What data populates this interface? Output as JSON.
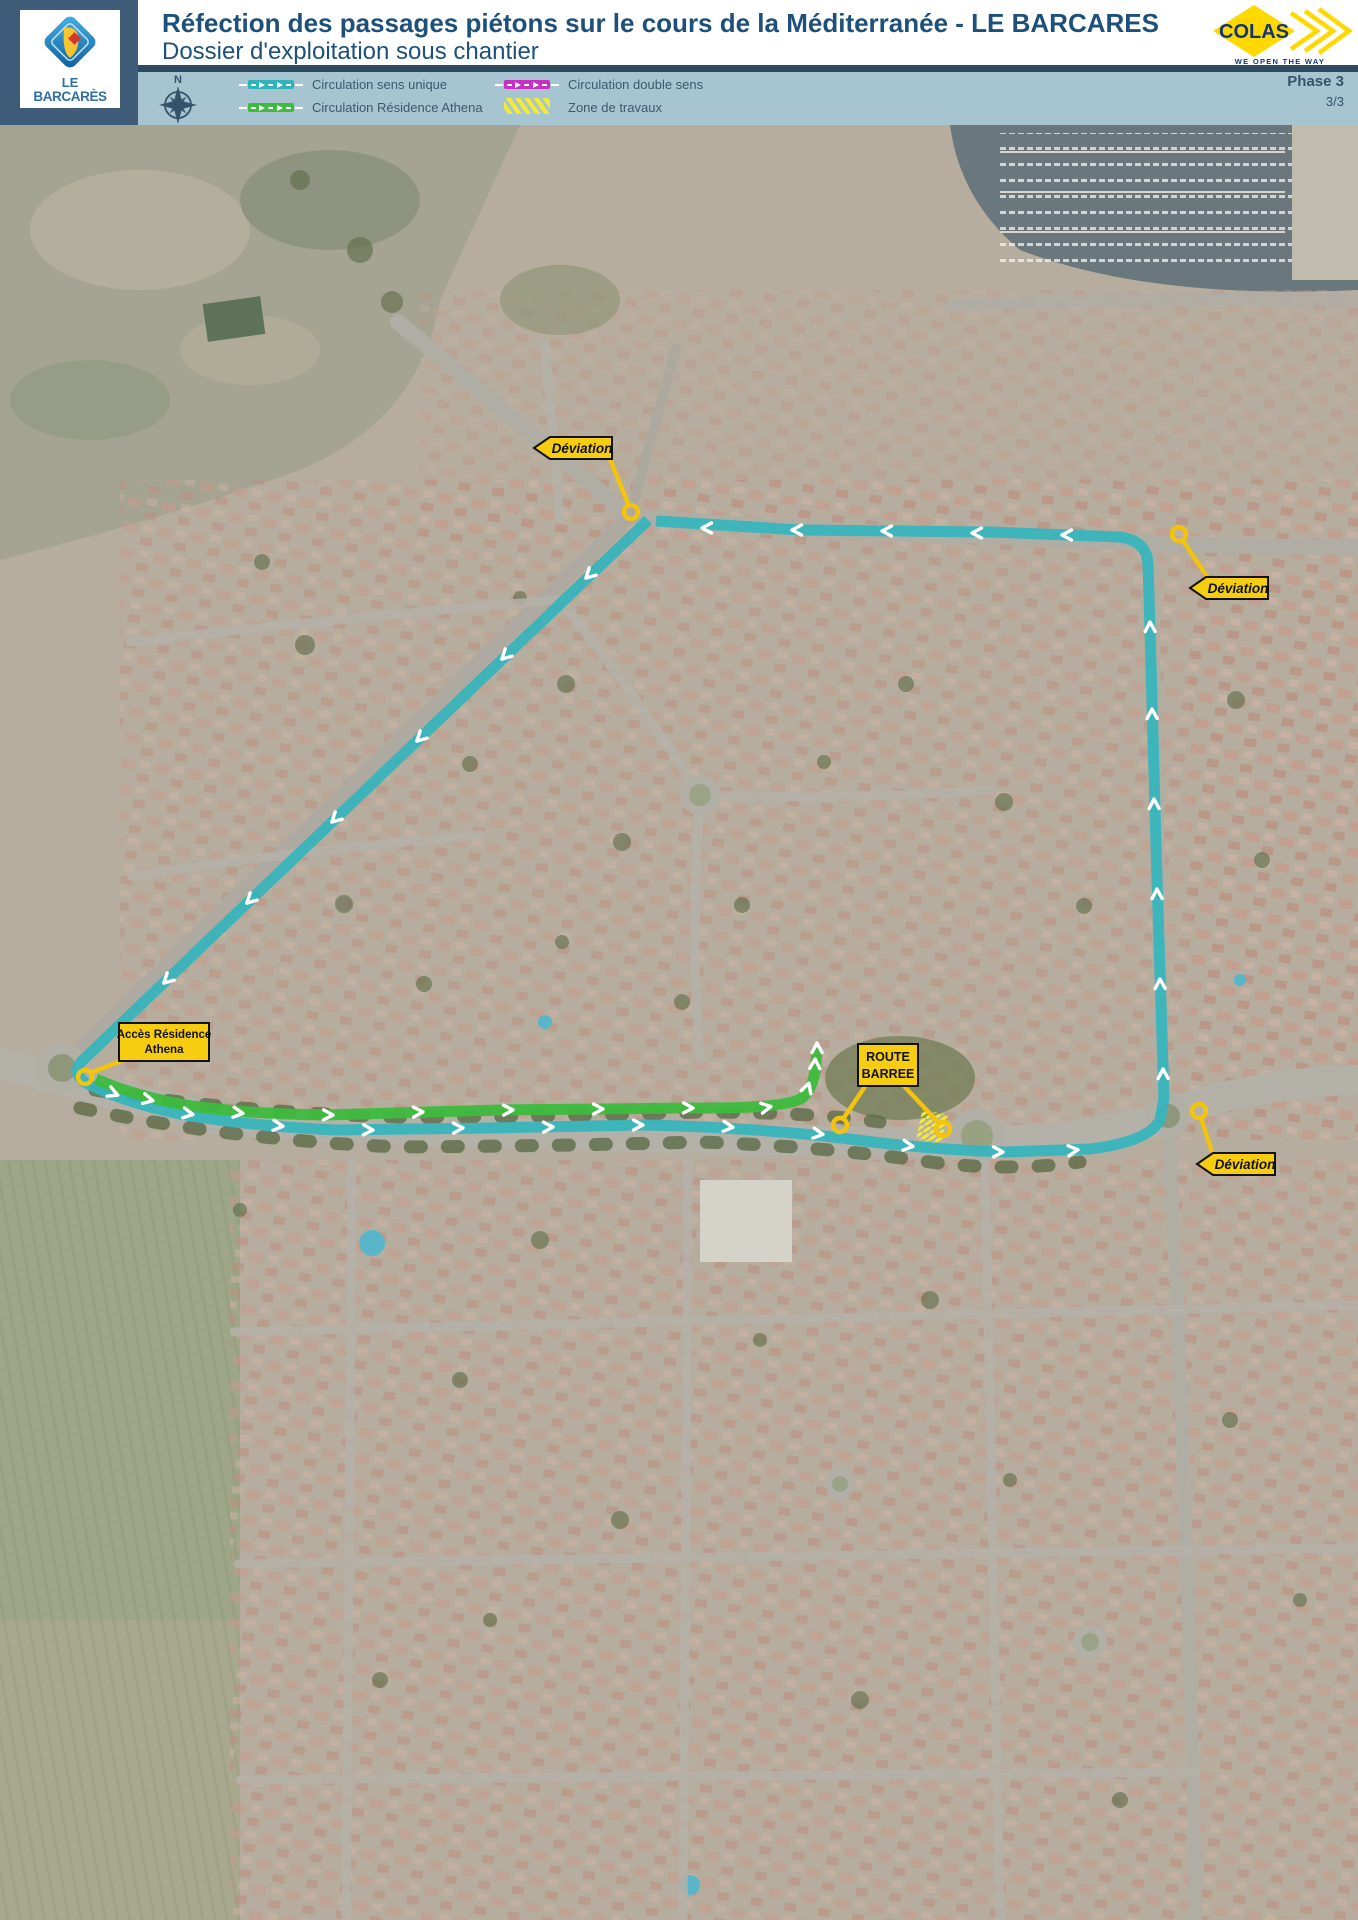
{
  "header": {
    "title": "Réfection des passages piétons sur le cours de la Méditerranée - LE BARCARES",
    "subtitle": "Dossier d'exploitation sous chantier"
  },
  "logo_barcares": {
    "line1": "LE",
    "line2": "BARCARÈS"
  },
  "logo_colas": {
    "name": "COLAS",
    "tagline": "WE OPEN THE WAY"
  },
  "legend": {
    "compass_north": "N",
    "items": [
      {
        "id": "sens-unique",
        "label": "Circulation sens unique",
        "color": "#2eb4ba",
        "style": "arrows"
      },
      {
        "id": "residence-athena",
        "label": "Circulation Résidence Athena",
        "color": "#3dbb3d",
        "style": "arrows"
      },
      {
        "id": "double-sens",
        "label": "Circulation double sens",
        "color": "#c92fc4",
        "style": "arrows"
      },
      {
        "id": "zone-travaux",
        "label": "Zone de travaux",
        "color": "#f2e93a",
        "style": "hatch"
      }
    ],
    "phase": "Phase 3",
    "page_number": "3/3"
  },
  "map": {
    "signs": {
      "deviation": "Déviation",
      "acces_residence_line1": "Accès Résidence",
      "acces_residence_line2": "Athena",
      "route_barree_line1": "ROUTE",
      "route_barree_line2": "BARREE"
    },
    "colors": {
      "route_sens_unique": "#35b5bc",
      "route_residence": "#3dbb3d",
      "sign_yellow": "#f6cd11",
      "work_zone": "#f2e93a"
    }
  }
}
